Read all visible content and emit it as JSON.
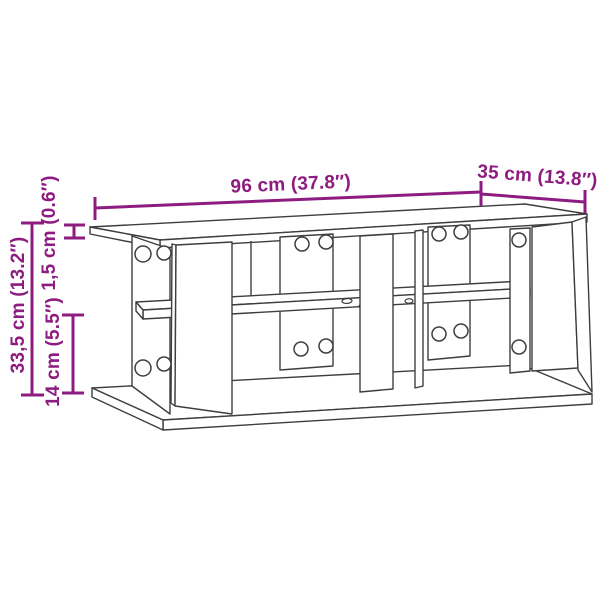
{
  "diagram": {
    "kind": "furniture-dimension-line-drawing",
    "colors": {
      "dimension_accent": "#8E1C80",
      "drawing_outline": "#3E3E3E",
      "background": "#FFFFFF"
    },
    "dimensions": {
      "width_label": "96 cm (37.8″)",
      "depth_label": "35 cm (13.8″)",
      "height_label": "33,5 cm (13.2″)",
      "top_panel_thickness_label": "1,5 cm (0.6″)",
      "bottom_clearance_label": "14 cm (5.5″)"
    }
  }
}
